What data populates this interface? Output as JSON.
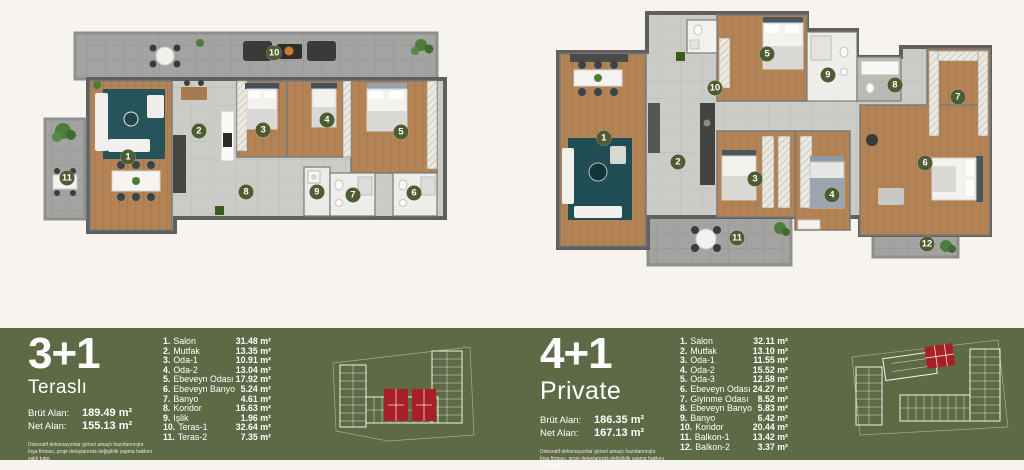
{
  "colors": {
    "page_bg": "#f7f4ef",
    "band_green": "#5e6946",
    "badge_green": "#4d5c31",
    "highlight_red": "#a91f26",
    "wood": "#b48355",
    "wall_gray": "#5f5f5d"
  },
  "units": [
    {
      "type_label": "3+1",
      "subtitle": "Teraslı",
      "brut_label": "Brüt Alan:",
      "brut_value": "189.49 m²",
      "net_label": "Net Alan:",
      "net_value": "155.13 m²",
      "disclaimer": "Dekoratif dekorasyonlar görsel amaçlı hazırlanmıştır. İnşa firması, proje detaylarında değişiklik yapma hakkını saklı tutar.",
      "rooms": [
        {
          "no": "1.",
          "name": "Salon",
          "area": "31.48 m²"
        },
        {
          "no": "2.",
          "name": "Mutfak",
          "area": "13.35 m²"
        },
        {
          "no": "3.",
          "name": "Oda-1",
          "area": "10.91 m²"
        },
        {
          "no": "4.",
          "name": "Oda-2",
          "area": "13.04 m²"
        },
        {
          "no": "5.",
          "name": "Ebeveyn Odası",
          "area": "17.92 m²"
        },
        {
          "no": "6.",
          "name": "Ebeveyn Banyo",
          "area": "5.24 m²"
        },
        {
          "no": "7.",
          "name": "Banyo",
          "area": "4.61 m²"
        },
        {
          "no": "8.",
          "name": "Koridor",
          "area": "16.63 m²"
        },
        {
          "no": "9.",
          "name": "İşlik",
          "area": "1.96 m²"
        },
        {
          "no": "10.",
          "name": "Teras-1",
          "area": "32.64 m²"
        },
        {
          "no": "11.",
          "name": "Teras-2",
          "area": "7.35 m²"
        }
      ],
      "badges": [
        {
          "n": "1",
          "x": 25.7,
          "y": 64.5
        },
        {
          "n": "2",
          "x": 41.8,
          "y": 52.7
        },
        {
          "n": "3",
          "x": 56.4,
          "y": 52.3
        },
        {
          "n": "4",
          "x": 70.9,
          "y": 47.7
        },
        {
          "n": "5",
          "x": 87.7,
          "y": 53.2
        },
        {
          "n": "6",
          "x": 90.7,
          "y": 80.9
        },
        {
          "n": "7",
          "x": 76.8,
          "y": 81.8
        },
        {
          "n": "8",
          "x": 52.5,
          "y": 80.5
        },
        {
          "n": "9",
          "x": 68.6,
          "y": 80.5
        },
        {
          "n": "10",
          "x": 58.9,
          "y": 17.3
        },
        {
          "n": "11",
          "x": 11.8,
          "y": 74.1
        }
      ]
    },
    {
      "type_label": "4+1",
      "subtitle": "Private",
      "brut_label": "Brüt Alan:",
      "brut_value": "186.35 m²",
      "net_label": "Net Alan:",
      "net_value": "167.13 m²",
      "disclaimer": "Dekoratif dekorasyonlar görsel amaçlı hazırlanmıştır. İnşa firması, proje detaylarında değişiklik yapma hakkını saklı tutar.",
      "rooms": [
        {
          "no": "1.",
          "name": "Salon",
          "area": "32.11 m²"
        },
        {
          "no": "2.",
          "name": "Mutfak",
          "area": "13.10 m²"
        },
        {
          "no": "3.",
          "name": "Oda-1",
          "area": "11.55 m²"
        },
        {
          "no": "4.",
          "name": "Oda-2",
          "area": "15.52 m²"
        },
        {
          "no": "5.",
          "name": "Oda-3",
          "area": "12.58 m²"
        },
        {
          "no": "6.",
          "name": "Ebeveyn Odası",
          "area": "24.27 m²"
        },
        {
          "no": "7.",
          "name": "Giyinme Odası",
          "area": "8.52 m²"
        },
        {
          "no": "8.",
          "name": "Ebeveyn Banyo",
          "area": "5.83 m²"
        },
        {
          "no": "9.",
          "name": "Banyo",
          "area": "6.42 m²"
        },
        {
          "no": "10.",
          "name": "Koridor",
          "area": "20.44 m²"
        },
        {
          "no": "11.",
          "name": "Balkon-1",
          "area": "13.42 m²"
        },
        {
          "no": "12.",
          "name": "Balkon-2",
          "area": "3.37 m²"
        }
      ],
      "badges": [
        {
          "n": "1",
          "x": 12.4,
          "y": 49.6
        },
        {
          "n": "2",
          "x": 28.9,
          "y": 58.8
        },
        {
          "n": "3",
          "x": 46.0,
          "y": 65.3
        },
        {
          "n": "4",
          "x": 63.1,
          "y": 71.4
        },
        {
          "n": "5",
          "x": 48.7,
          "y": 17.6
        },
        {
          "n": "6",
          "x": 83.8,
          "y": 59.2
        },
        {
          "n": "7",
          "x": 91.1,
          "y": 34.0
        },
        {
          "n": "8",
          "x": 77.1,
          "y": 29.4
        },
        {
          "n": "9",
          "x": 62.2,
          "y": 25.6
        },
        {
          "n": "10",
          "x": 37.1,
          "y": 30.5
        },
        {
          "n": "11",
          "x": 42.0,
          "y": 87.8
        },
        {
          "n": "12",
          "x": 84.2,
          "y": 90.1
        }
      ]
    }
  ]
}
